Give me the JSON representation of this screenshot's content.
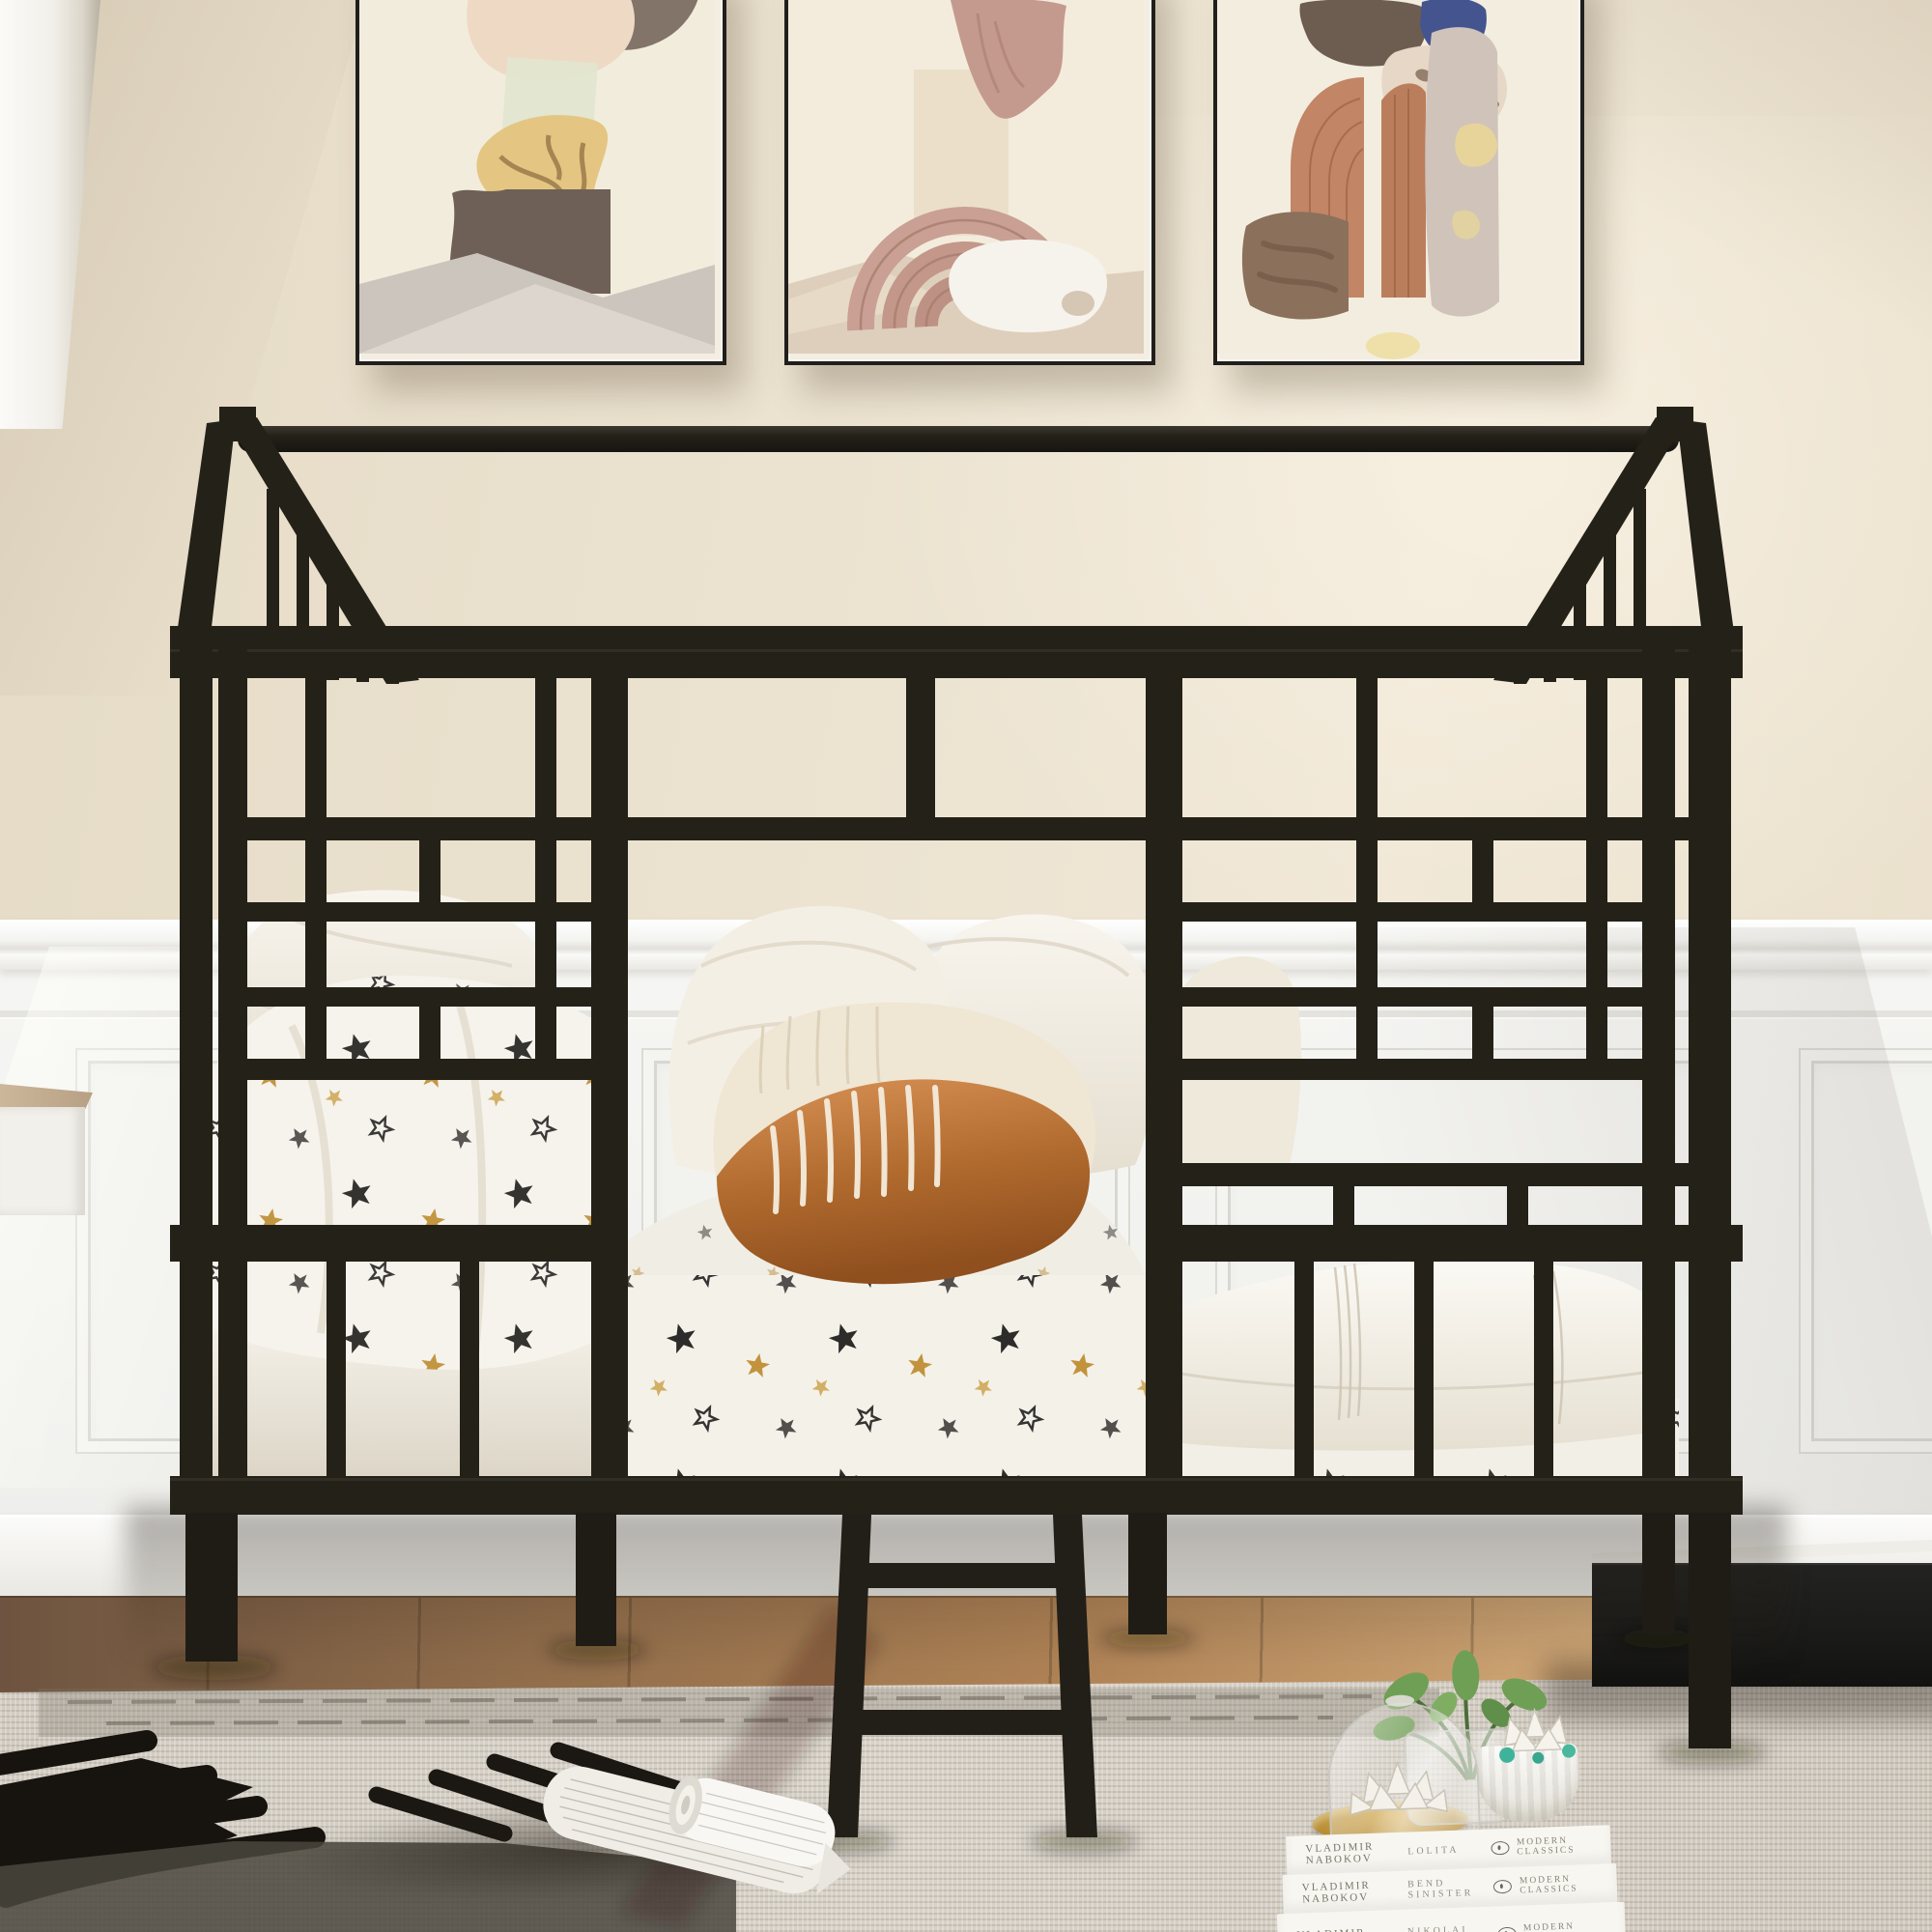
{
  "scene": {
    "setting": "kids bedroom: beige wall, white wainscoting panels, dark wood floor, grey woven rug with black brush pattern",
    "subject": "black metal house-frame twin bed with geometric headboard grids, roof ridge with gable spindles, guard rails and short ladder",
    "bedding": "star-print quilt and mattress, white pillows, terracotta striped lumbar pillow, folded white duvet",
    "props": [
      "three abstract wall prints",
      "rolled magazine on rug",
      "stack of Penguin Modern Classics books with succulents, glass cloche and jar plant",
      "black nightstand",
      "white cabinet edge",
      "small wall shelf"
    ]
  },
  "wall_art": [
    {
      "name": "abstract print - stone on plinth",
      "palette": [
        "#83746a",
        "#eed9c5",
        "#e2e6cf",
        "#e4c682",
        "#6e6057"
      ]
    },
    {
      "name": "abstract print - arch and drape",
      "palette": [
        "#c59a8e",
        "#e9ddc6",
        "#c9a093",
        "#f6f3ec"
      ]
    },
    {
      "name": "abstract print - split arch and shapes",
      "palette": [
        "#6d5c50",
        "#44548f",
        "#e7d7c6",
        "#c28565",
        "#cfc3ba"
      ]
    }
  ],
  "books": {
    "stack": [
      {
        "author": "VLADIMIR NABOKOV",
        "title": "LOLITA",
        "imprint": "MODERN CLASSICS"
      },
      {
        "author": "VLADIMIR NABOKOV",
        "title": "BEND SINISTER",
        "imprint": "MODERN CLASSICS"
      },
      {
        "author": "VLADIMIR NABOKOV",
        "title": "NIKOLAI GOGOL",
        "imprint": "MODERN CLASSICS"
      }
    ]
  },
  "palette": {
    "wall": "#ebe2d0",
    "wainscot": "#f3f3f0",
    "frame_black": "#242118",
    "floor_wood": "#b08356",
    "rug": "#d5cfc5",
    "terracotta_pillow": "#b06a2e",
    "star_gold": "#bf8e33",
    "star_black": "#232220",
    "plant_green": "#6f9f55",
    "teal_accent": "#3fb39a",
    "tray_gold": "#c59f45"
  }
}
